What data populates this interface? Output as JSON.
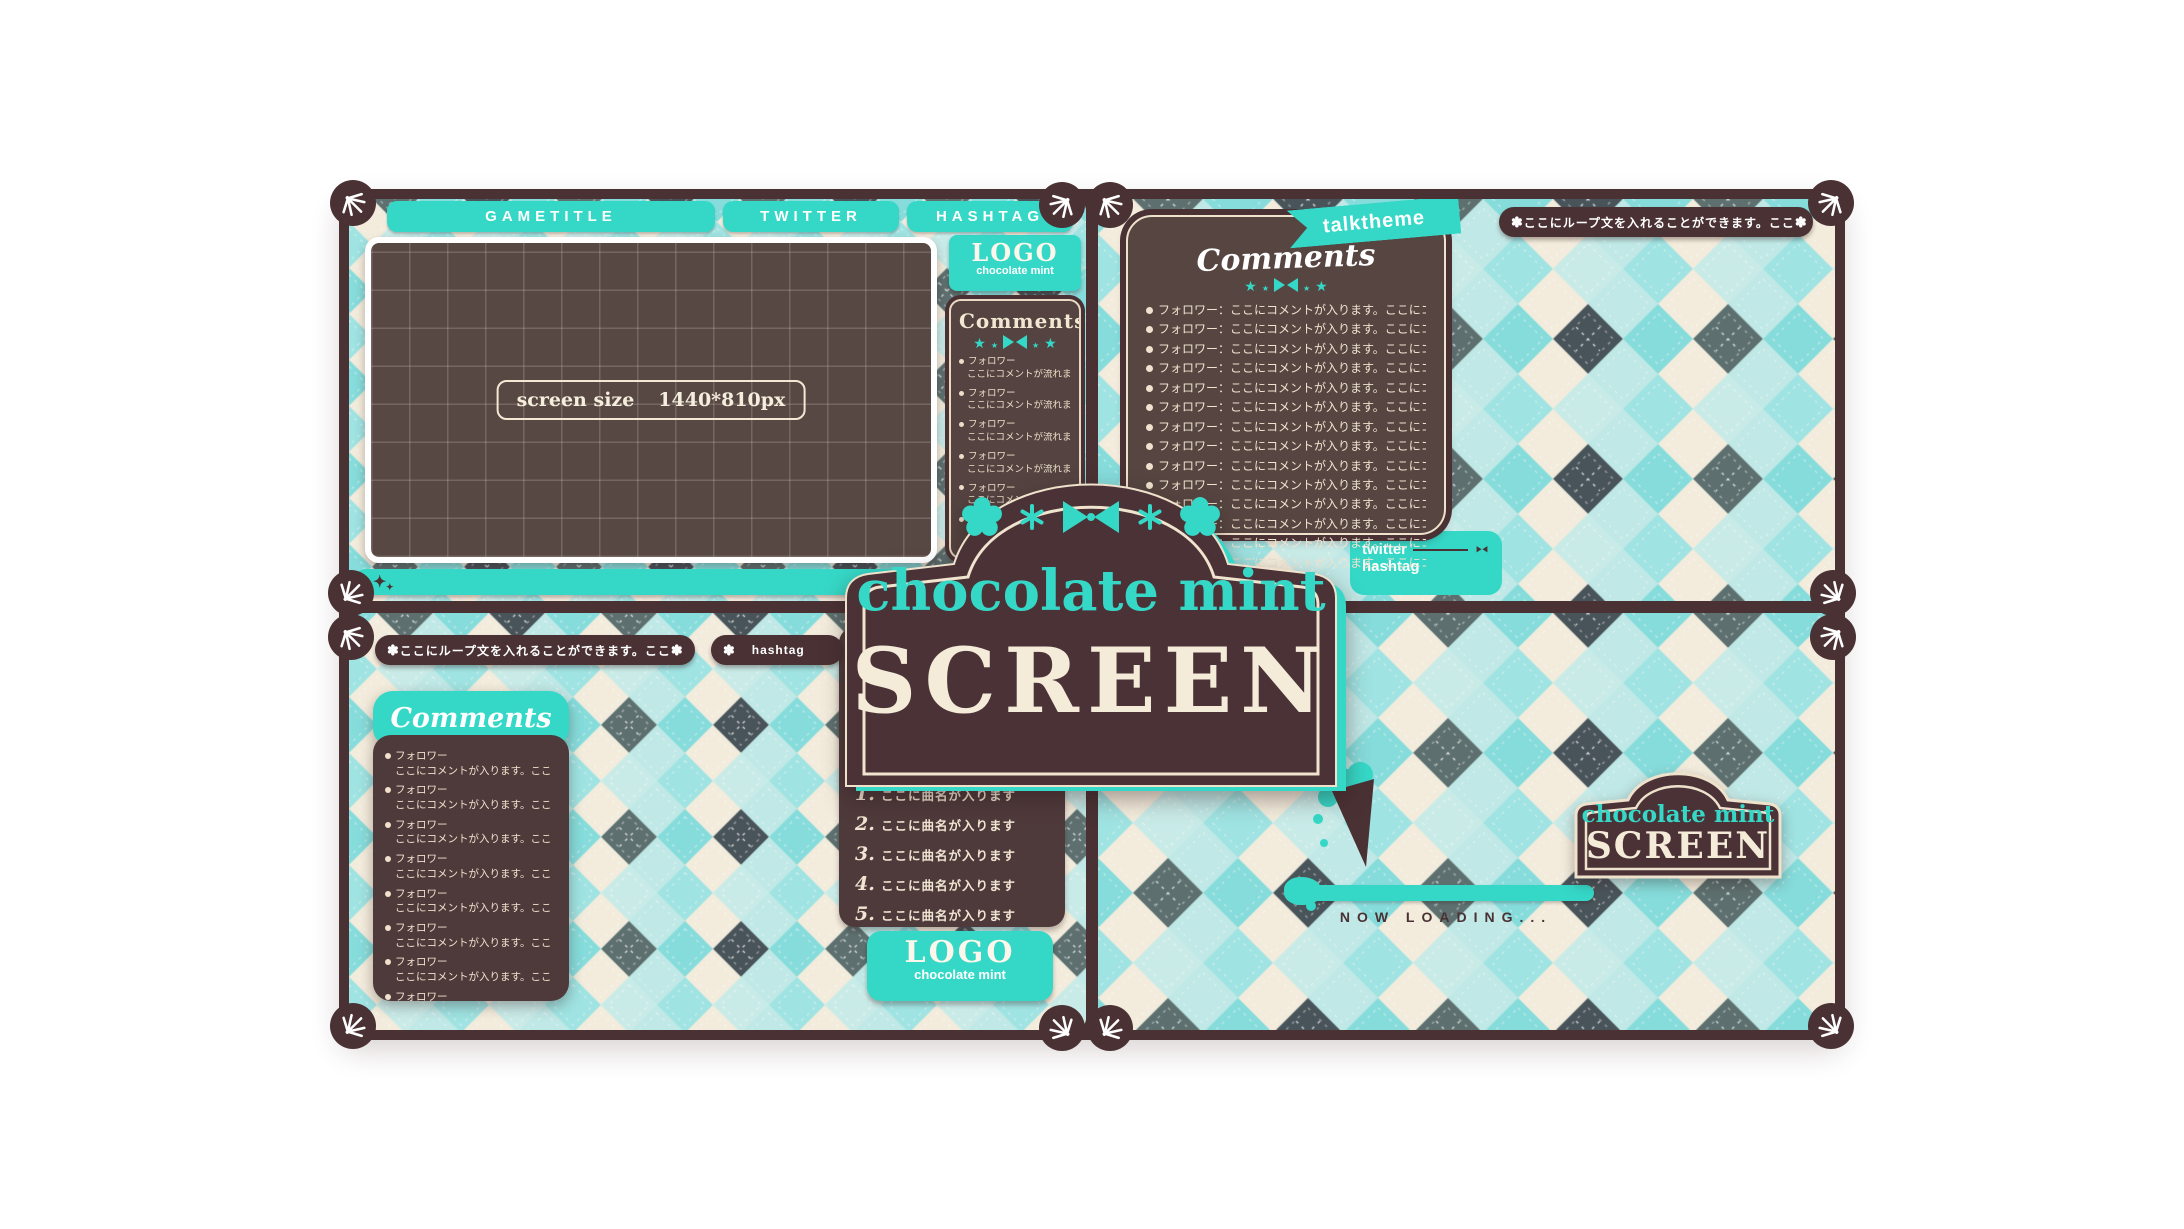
{
  "colors": {
    "mint": "#35d8c7",
    "frame_brown": "#4a3134",
    "panel_brown": "#564541",
    "cream": "#f2e9d6",
    "dark_text": "#4a3134"
  },
  "icons": {
    "corner_ornament": "leaf-burst-icon",
    "badge_flower": "flower-icon",
    "comment_decor": "star-bow-star-icons",
    "bar_sparkle": "sparkle-icon",
    "loading_decor": "ice-cream-cone-icon",
    "plaque_decor": "flower-asterisk-bow-asterisk-flower-icons"
  },
  "plaque": {
    "title": "chocolate mint",
    "subtitle": "SCREEN"
  },
  "game_panel": {
    "tabs": [
      "GAMETITLE",
      "TWITTER",
      "HASHTAG"
    ],
    "screen_label": "screen size",
    "screen_value": "1440*810px",
    "logo": {
      "title": "LOGO",
      "subtitle": "chocolate mint"
    },
    "comments": {
      "title": "Comments",
      "entries": [
        {
          "name": "フォロワー",
          "text": "ここにコメントが流れます"
        },
        {
          "name": "フォロワー",
          "text": "ここにコメントが流れます"
        },
        {
          "name": "フォロワー",
          "text": "ここにコメントが流れます"
        },
        {
          "name": "フォロワー",
          "text": "ここにコメントが流れます"
        },
        {
          "name": "フォロワー",
          "text": "ここにコメントが流れます"
        },
        {
          "name": "フォロワー",
          "text": "ここにコメントが流れます"
        },
        {
          "name": "フォロワー",
          "text": "ここにコメントが流れます"
        },
        {
          "name": "フォロワー",
          "text": "ここにコメントが流れます"
        }
      ]
    }
  },
  "talk_panel": {
    "ribbon": "talktheme",
    "loop_badge": "ここにループ文を入れることができます。ここ",
    "comments_title": "Comments",
    "entries": [
      "フォロワー：ここにコメントが入ります。ここにコメ",
      "フォロワー：ここにコメントが入ります。ここにコメ",
      "フォロワー：ここにコメントが入ります。ここにコメ",
      "フォロワー：ここにコメントが入ります。ここにコメ",
      "フォロワー：ここにコメントが入ります。ここにコメ",
      "フォロワー：ここにコメントが入ります。ここにコメ",
      "フォロワー：ここにコメントが入ります。ここにコメ",
      "フォロワー：ここにコメントが入ります。ここにコメ",
      "フォロワー：ここにコメントが入ります。ここにコメ",
      "フォロワー：ここにコメントが入ります。ここにコメ",
      "フォロワー：ここにコメントが入ります。ここにコメ",
      "フォロワー：ここにコメントが入ります。ここにコメ",
      "フォロワー：ここにコメントが入ります。ここにコメ",
      "フォロワー：ここにコメントが入ります。ここにコメ"
    ],
    "links": [
      "twitter",
      "hashtag"
    ]
  },
  "music_panel": {
    "loop_badge": "ここにループ文を入れることができます。ここ",
    "hashtag_badge": "hashtag",
    "comments": {
      "title": "Comments",
      "entries": [
        {
          "name": "フォロワー",
          "text": "ここにコメントが入ります。ここ"
        },
        {
          "name": "フォロワー",
          "text": "ここにコメントが入ります。ここ"
        },
        {
          "name": "フォロワー",
          "text": "ここにコメントが入ります。ここ"
        },
        {
          "name": "フォロワー",
          "text": "ここにコメントが入ります。ここ"
        },
        {
          "name": "フォロワー",
          "text": "ここにコメントが入ります。ここ"
        },
        {
          "name": "フォロワー",
          "text": "ここにコメントが入ります。ここ"
        },
        {
          "name": "フォロワー",
          "text": "ここにコメントが入ります。ここ"
        },
        {
          "name": "フォロワー",
          "text": "ここにコメントが入ります。ここ"
        }
      ]
    },
    "songs": [
      {
        "no": "1.",
        "title": "ここに曲名が入ります"
      },
      {
        "no": "2.",
        "title": "ここに曲名が入ります"
      },
      {
        "no": "3.",
        "title": "ここに曲名が入ります"
      },
      {
        "no": "4.",
        "title": "ここに曲名が入ります"
      },
      {
        "no": "5.",
        "title": "ここに曲名が入ります"
      }
    ],
    "logo": {
      "title": "LOGO",
      "subtitle": "chocolate mint"
    }
  },
  "loading_panel": {
    "plaque_title": "chocolate mint",
    "plaque_subtitle": "SCREEN",
    "status": "NOW LOADING..."
  }
}
